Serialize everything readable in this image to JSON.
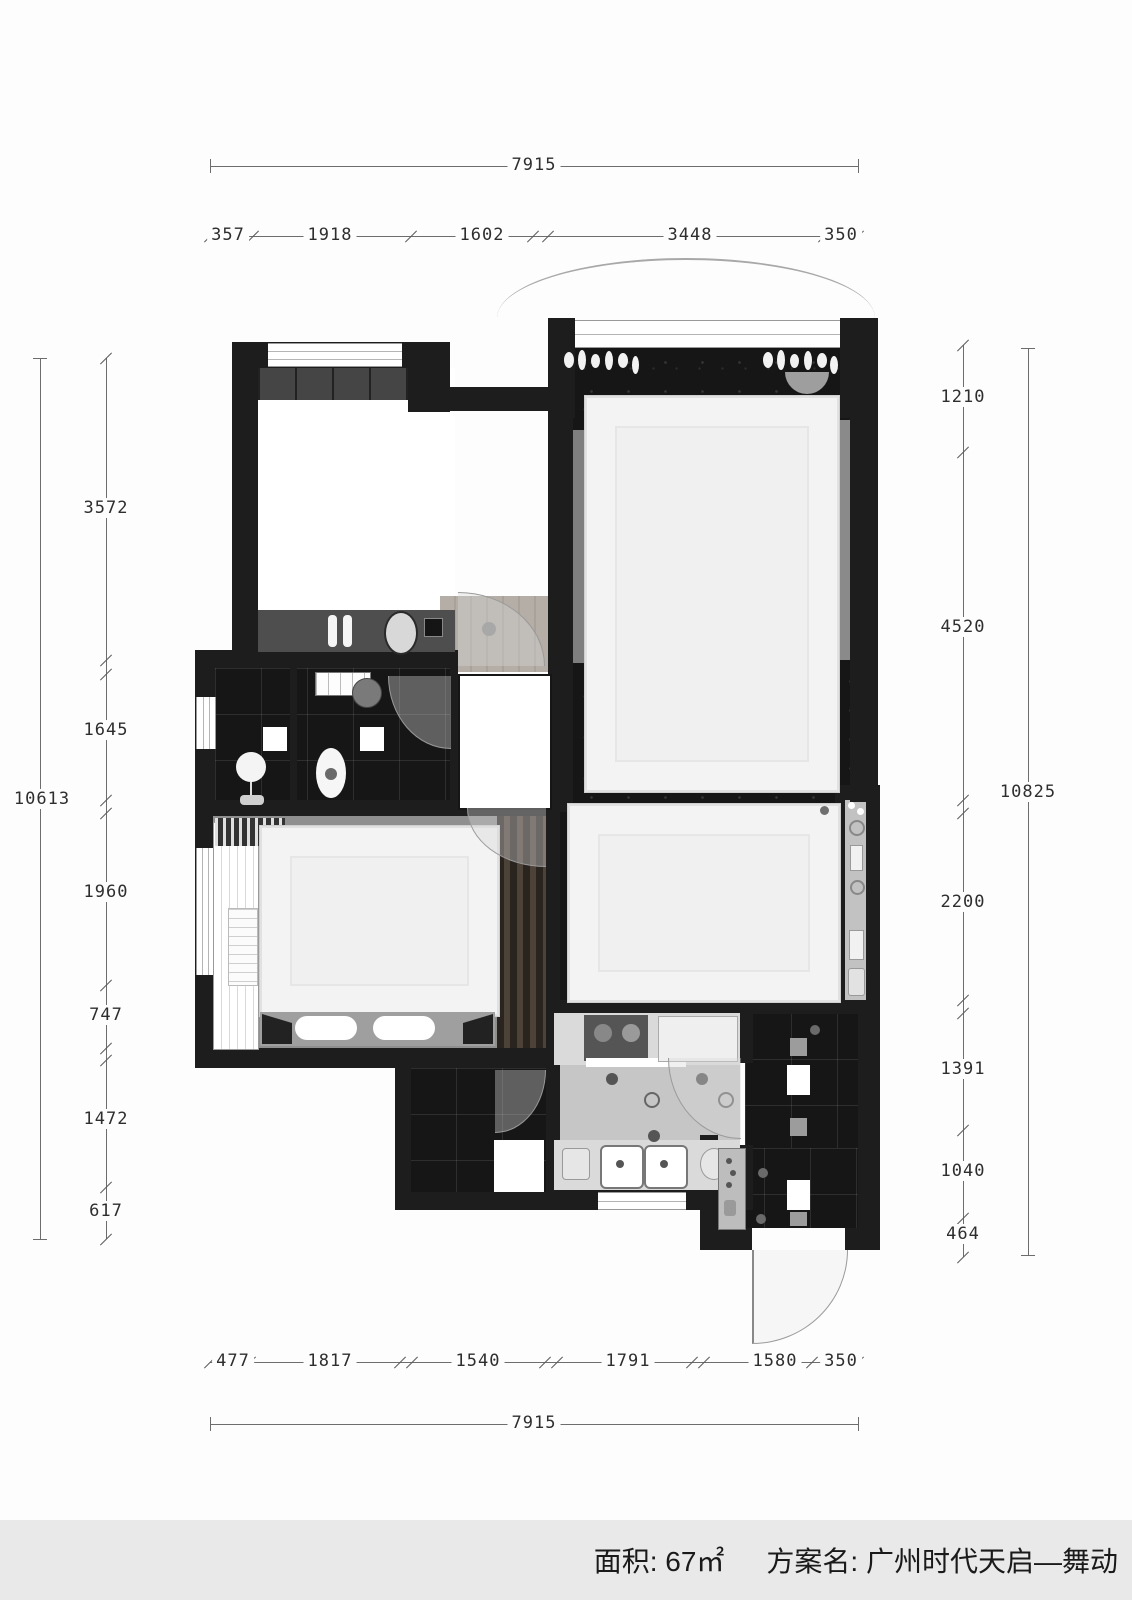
{
  "title_bar": {
    "area_label": "面积:",
    "area_value": "67㎡",
    "plan_label": "方案名:",
    "plan_name": "广州时代天启—舞动"
  },
  "dimensions": {
    "top": {
      "total": "7915",
      "segments": [
        "357",
        "1918",
        "1602",
        "3448",
        "350"
      ]
    },
    "bottom": {
      "total": "7915",
      "segments": [
        "477",
        "1817",
        "1540",
        "1791",
        "1580",
        "350"
      ]
    },
    "left": {
      "total": "10613",
      "segments": [
        "3572",
        "1645",
        "1960",
        "747",
        "1472",
        "617"
      ]
    },
    "right": {
      "total": "10825",
      "segments": [
        "1210",
        "4520",
        "2200",
        "1391",
        "1040",
        "464"
      ]
    }
  },
  "colors": {
    "wall": "#1d1d1d",
    "dark_floor": "#161616",
    "light_floor": "#c6c6c6",
    "rug": "#f3f3f3",
    "bottom_bar": "#e9e9e9",
    "dim_line": "#6d6d6d"
  },
  "units": "mm"
}
